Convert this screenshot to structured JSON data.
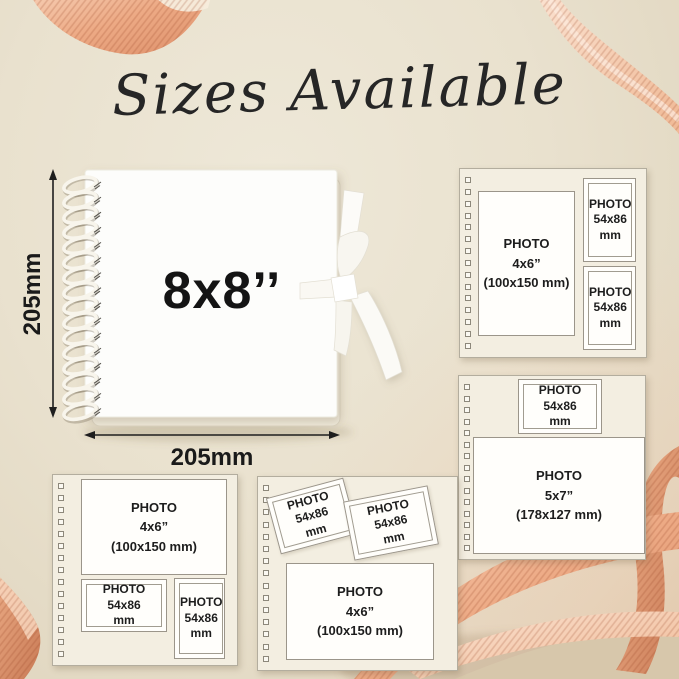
{
  "title": "Sizes Available",
  "album": {
    "size_label": "8x8’’",
    "height_label": "205mm",
    "width_label": "205mm"
  },
  "panels": [
    {
      "name": "page-4x6-with-two-small",
      "slots": [
        {
          "lines": [
            "PHOTO",
            "4x6”",
            "(100x150 mm)"
          ]
        },
        {
          "lines": [
            "PHOTO",
            "54x86",
            "mm"
          ]
        },
        {
          "lines": [
            "PHOTO",
            "54x86",
            "mm"
          ]
        }
      ]
    },
    {
      "name": "page-small-top-5x7",
      "slots": [
        {
          "lines": [
            "PHOTO",
            "54x86",
            "mm"
          ]
        },
        {
          "lines": [
            "PHOTO",
            "5x7”",
            "(178x127 mm)"
          ]
        }
      ]
    },
    {
      "name": "page-4x6-top-two-small-below",
      "slots": [
        {
          "lines": [
            "PHOTO",
            "4x6”",
            "(100x150 mm)"
          ]
        },
        {
          "lines": [
            "PHOTO",
            "54x86",
            "mm"
          ]
        },
        {
          "lines": [
            "PHOTO",
            "54x86",
            "mm"
          ]
        }
      ]
    },
    {
      "name": "page-two-tilted-4x6-below",
      "slots": [
        {
          "lines": [
            "PHOTO",
            "54x86",
            "mm"
          ]
        },
        {
          "lines": [
            "PHOTO",
            "54x86",
            "mm"
          ]
        },
        {
          "lines": [
            "PHOTO",
            "4x6”",
            "(100x150 mm)"
          ]
        }
      ]
    }
  ],
  "colors": {
    "background": "#e9e1ce",
    "page_cream": "#f3eee1",
    "slot_border": "#9b958a",
    "text": "#1d1d1d",
    "ribbon_main": "#edaa85",
    "ribbon_deep": "#c97a55",
    "ribbon_light": "#f7d9c4"
  }
}
